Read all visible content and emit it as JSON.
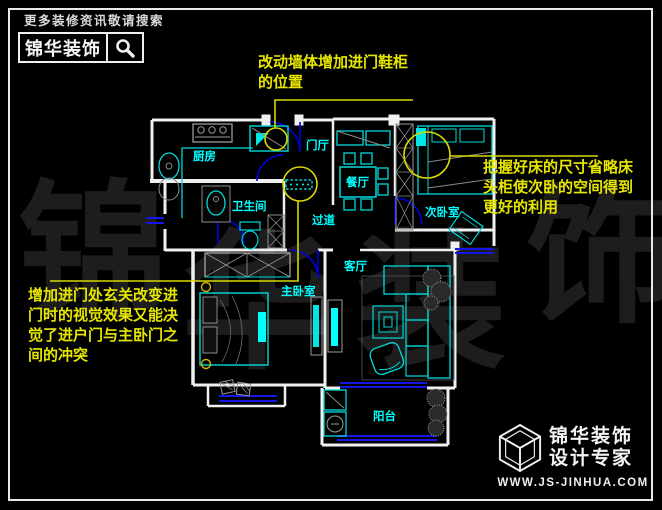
{
  "header": {
    "search_hint": "更多装修资讯敬请搜索",
    "brand": "锦华装饰"
  },
  "annotations": {
    "top": {
      "lines": [
        "改动墙体增加进门鞋柜",
        "的位置"
      ]
    },
    "right": {
      "lines": [
        "把握好床的尺寸省略床",
        "头柜使次卧的空间得到",
        "更好的利用"
      ]
    },
    "left": {
      "lines": [
        "增加进门处玄关改变进",
        "门时的视觉效果又能决",
        "觉了进户门与主卧门之",
        "间的冲突"
      ]
    }
  },
  "rooms": {
    "kitchen": {
      "label": "厨房"
    },
    "foyer": {
      "label": "门厅"
    },
    "dining": {
      "label": "餐厅"
    },
    "bathroom": {
      "label": "卫生间"
    },
    "corridor": {
      "label": "过道"
    },
    "bedroom2": {
      "label": "次卧室"
    },
    "bedroom1": {
      "label": "主卧室"
    },
    "living": {
      "label": "客厅"
    },
    "balcony": {
      "label": "阳台"
    }
  },
  "watermark": {
    "chars": [
      "锦",
      "华",
      "装",
      "饰"
    ]
  },
  "footer": {
    "brand": "锦华装饰",
    "tagline": "设计专家",
    "url": "WWW.JS-JINHUA.COM"
  },
  "colors": {
    "background": "#000000",
    "wall": "#f0f0f0",
    "furniture": "#00d9d9",
    "accent": "#00ffff",
    "window": "#1515e8",
    "door": "#0000e0",
    "annotation": "#e6e600",
    "watermark": "#1d1d1d"
  }
}
